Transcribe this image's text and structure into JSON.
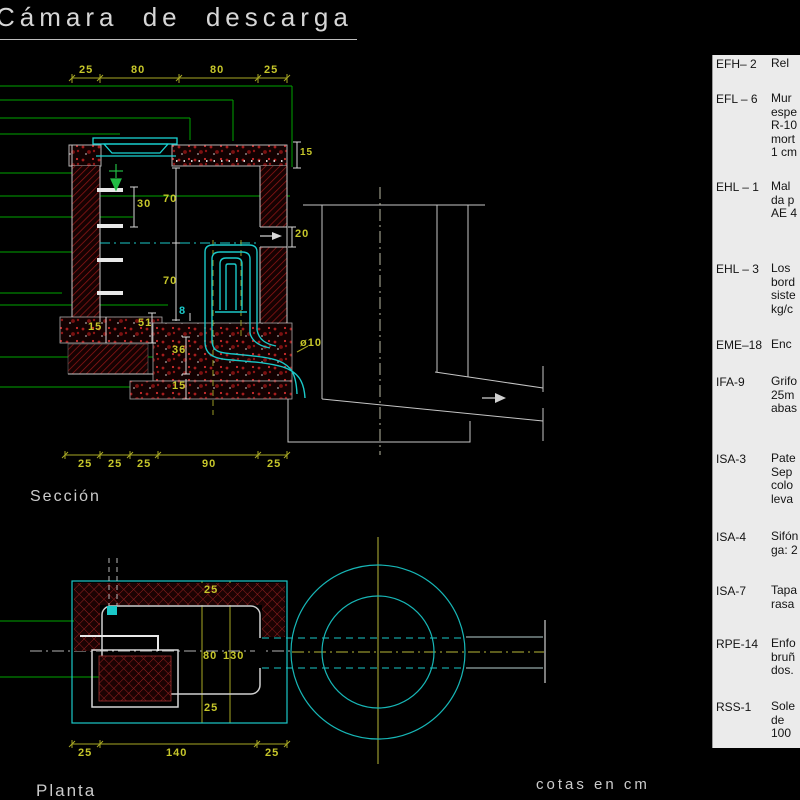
{
  "title": "Cámara de descarga",
  "labels": {
    "section": "Sección",
    "plan": "Planta",
    "units": "cotas en cm"
  },
  "section": {
    "dim_top": [
      "25",
      "80",
      "80",
      "25"
    ],
    "dim_bottom": [
      "25",
      "25",
      "25",
      "90",
      "25"
    ],
    "slab_thickness": "15",
    "rung_spacing": "30",
    "depth_upper": "70",
    "depth_lower": "70",
    "inlet_opening": "20",
    "footing_thickness": "15",
    "foundation_total": "51",
    "bed_height": "36",
    "base_thickness": "15",
    "siphon_pipe_dia": "8",
    "outlet_pipe_dia": "ø10"
  },
  "plan": {
    "wall_top": "25",
    "inner_width": "80",
    "overall_width": "130",
    "wall_bottom": "25",
    "dim_bottom": [
      "25",
      "140",
      "25"
    ]
  },
  "legend": {
    "items": [
      {
        "code": "EFH– 2",
        "desc": "Rel"
      },
      {
        "code": "EFL – 6",
        "desc": "Mur\nespe\nR-10\nmort\n1 cm"
      },
      {
        "code": "EHL – 1",
        "desc": "Mal\nda p\nAE 4"
      },
      {
        "code": "EHL – 3",
        "desc": "Los\nbord\nsiste\nkg/c"
      },
      {
        "code": "EME–18",
        "desc": "Enc"
      },
      {
        "code": "IFA-9",
        "desc": "Grifo\n25m\nabas"
      },
      {
        "code": "ISA-3",
        "desc": "Pate\nSep\ncolo\nleva"
      },
      {
        "code": "ISA-4",
        "desc": "Sifón\nga: 2"
      },
      {
        "code": "ISA-7",
        "desc": "Tapa\nrasa"
      },
      {
        "code": "RPE-14",
        "desc": "Enfo\nbruñ\ndos."
      },
      {
        "code": "RSS-1",
        "desc": "Sole\nde\n100"
      }
    ]
  },
  "colors": {
    "dimension_yellow": "#c6c62a",
    "leader_green": "#00a300",
    "pipe_cyan": "#1ac8c8",
    "hatch_red": "#8f1616",
    "panel_bg": "#ebebeb",
    "structure_white": "#c6c6c6"
  }
}
